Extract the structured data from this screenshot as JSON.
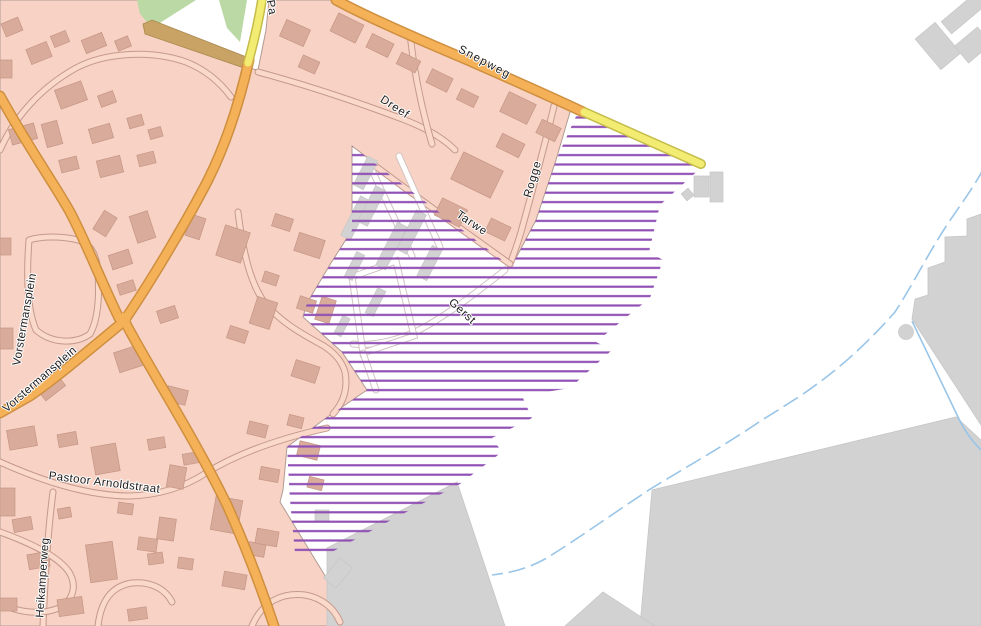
{
  "map": {
    "width": 981,
    "height": 626,
    "colors": {
      "background": "#ffffff",
      "residential": "#F8D3C5",
      "residential_boundary": "#B19B93",
      "building_fill": "#D8AB9B",
      "building_stroke": "#C69685",
      "gray_fill": "#D2D2D2",
      "gray_stroke": "#C6C6C6",
      "road_orange": "#F4B158",
      "road_orange_casing": "#CE8F3F",
      "road_yellow": "#F2EC72",
      "road_yellow_casing": "#C5BC4A",
      "path_tan": "#C9A366",
      "path_tan_stroke": "#A8874E",
      "green": "#BBD9A4",
      "hatch_purple": "#9050B4",
      "water_blue": "#99C5E8",
      "minor_road_fill": "#FAD8CA",
      "minor_road_casing": "#C49A8C",
      "hatch_road_fill": "#FFFFFF",
      "hatch_road_casing": "#D2C4C0"
    },
    "hatch_spacing": 9.4,
    "hatch_line_width": 2.2,
    "residential_area": "0,0 139,0 150,26 148,33 243,67 258,70 266,30 269,0 332,0 380,20 445,48 505,76 560,100 578,110 570,112 556,160 536,220 516,258 510,266 352,146 352,230 331,263 307,303 303,317 342,352 367,390 326,418 287,447 283,490 280,502 338,597 352,626 0,626",
    "green_areas": [
      "137,0 196,0 152,28 140,14",
      "219,0 247,0 240,42 227,28"
    ],
    "tan_path": "143,24 152,20 249,58 244,68 145,34",
    "gray_areas": [
      "967,219 981,214 981,425 912,319 915,299 928,295 928,268 945,262 945,237 967,236",
      "640,626 652,490 956,417 981,440 981,626",
      "457,482 505,626 327,626 327,548",
      "565,626 603,592 655,626"
    ],
    "gray_circle": {
      "cx": 906,
      "cy": 332,
      "r": 8
    },
    "hatch_zone": "352,146 510,266 516,258 536,220 556,160 578,112 585,115 703,166 660,205 649,252 663,260 650,298 596,342 612,350 570,388 522,396 532,418 492,438 502,452 460,484 395,518 330,553 295,553 290,500 287,447 326,418 367,390 342,352 303,317 307,303 331,263 352,230",
    "major_roads": [
      {
        "name": "road-vorstermansplein-north",
        "type": "orange",
        "d": "M 0,96 C 30,150 55,185 70,212 C 85,240 105,290 119,318"
      },
      {
        "name": "road-main-north",
        "type": "orange",
        "d": "M 249,60 C 240,100 228,140 208,180 C 190,215 155,275 126,318"
      },
      {
        "name": "road-main-south",
        "type": "orange",
        "d": "M 124,320 C 150,370 190,430 227,505 C 245,545 262,590 274,626"
      },
      {
        "name": "road-vorstermansplein-southwest",
        "type": "orange",
        "d": "M 123,322 C 95,345 60,375 30,396 L 0,413"
      },
      {
        "name": "road-snepweg",
        "type": "orange",
        "d": "M 336,0 C 365,16 420,40 470,61 C 515,81 556,99 583,112"
      },
      {
        "name": "road-yellow-north",
        "type": "yellow",
        "d": "M 262,0 C 258,25 253,45 248,63"
      },
      {
        "name": "road-yellow-east",
        "type": "yellow",
        "d": "M 584,112 Q 645,139 701,164"
      }
    ],
    "junction": {
      "cx": 124,
      "cy": 319,
      "r": 6
    },
    "minor_roads": [
      {
        "name": "road-dreef",
        "d": "M 258,72 C 310,86 360,103 405,120 C 428,129 444,139 455,150"
      },
      {
        "name": "road-dreef-connector",
        "d": "M 432,144 C 422,110 414,72 410,34"
      },
      {
        "name": "road-rogge",
        "d": "M 554,106 C 546,140 534,185 521,232 C 517,246 513,256 510,264"
      },
      {
        "name": "road-tarwe",
        "d": "M 510,264 C 468,234 418,198 370,162"
      },
      {
        "name": "road-northwest-block",
        "d": "M 0,150 C 14,118 40,88 76,68 C 106,52 152,50 186,62 C 206,70 220,82 231,97"
      },
      {
        "name": "road-plein-ring",
        "d": "M 29,240 C 26,280 28,312 36,330 C 52,344 76,344 90,334 C 99,318 100,290 97,264 C 94,250 88,243 78,240 C 62,236 42,236 29,240"
      },
      {
        "name": "road-east-loop",
        "d": "M 238,212 C 243,252 250,282 264,302 C 282,324 306,336 324,346 C 336,354 342,362 345,372 C 348,388 344,402 333,414"
      },
      {
        "name": "road-pastoor-arnoldstraat",
        "d": "M 0,462 C 40,480 86,496 130,496 C 162,495 186,486 206,473 C 240,452 282,438 327,428"
      },
      {
        "name": "road-heikamperweg",
        "d": "M 53,492 C 48,530 45,575 43,626"
      },
      {
        "name": "road-southwest-loop",
        "d": "M 0,532 C 28,542 58,556 69,572 C 77,585 74,600 59,608 C 40,616 14,612 0,602"
      },
      {
        "name": "road-south-curl",
        "d": "M 98,626 C 101,600 112,586 132,583 C 152,581 166,590 172,602"
      },
      {
        "name": "road-south-curl-2",
        "d": "M 252,626 C 262,602 282,592 305,595 C 322,598 334,608 340,622"
      }
    ],
    "hatch_roads": [
      {
        "name": "road-gerst",
        "d": "M 505,270 C 472,296 443,318 417,331 C 396,341 372,346 353,344"
      },
      {
        "name": "road-gerst-loop",
        "d": "M 352,277 L 396,261 L 414,336 L 363,353 Z"
      },
      {
        "name": "road-gerst-spur",
        "d": "M 363,353 L 376,390"
      },
      {
        "name": "road-hatch-lane-1",
        "d": "M 371,168 C 385,198 399,228 412,256"
      },
      {
        "name": "road-hatch-lane-2",
        "d": "M 399,156 C 412,186 427,218 440,247"
      }
    ],
    "buildings_residential": [
      [
        3,
        20,
        18,
        14,
        -22
      ],
      [
        28,
        45,
        22,
        16,
        -22
      ],
      [
        52,
        33,
        16,
        12,
        -22
      ],
      [
        0,
        60,
        12,
        18,
        0
      ],
      [
        83,
        36,
        22,
        14,
        -22
      ],
      [
        116,
        38,
        14,
        11,
        -22
      ],
      [
        57,
        85,
        28,
        20,
        -20
      ],
      [
        99,
        93,
        16,
        12,
        -20
      ],
      [
        10,
        126,
        26,
        16,
        -15
      ],
      [
        44,
        122,
        16,
        24,
        -15
      ],
      [
        90,
        126,
        22,
        15,
        -16
      ],
      [
        128,
        116,
        15,
        11,
        -16
      ],
      [
        149,
        128,
        13,
        10,
        -16
      ],
      [
        60,
        158,
        18,
        13,
        -14
      ],
      [
        98,
        158,
        24,
        17,
        -14
      ],
      [
        138,
        153,
        17,
        12,
        -14
      ],
      [
        282,
        24,
        26,
        18,
        24
      ],
      [
        300,
        58,
        18,
        13,
        24
      ],
      [
        333,
        18,
        28,
        20,
        26
      ],
      [
        368,
        38,
        24,
        15,
        26
      ],
      [
        398,
        56,
        21,
        13,
        26
      ],
      [
        428,
        73,
        23,
        15,
        26
      ],
      [
        458,
        92,
        19,
        12,
        26
      ],
      [
        503,
        97,
        30,
        22,
        26
      ],
      [
        538,
        123,
        21,
        15,
        26
      ],
      [
        498,
        138,
        25,
        15,
        26
      ],
      [
        455,
        160,
        44,
        30,
        26
      ],
      [
        437,
        203,
        28,
        19,
        26
      ],
      [
        487,
        222,
        22,
        15,
        26
      ],
      [
        94,
        216,
        22,
        15,
        -58
      ],
      [
        133,
        213,
        19,
        28,
        -18
      ],
      [
        110,
        252,
        21,
        15,
        -18
      ],
      [
        118,
        282,
        17,
        11,
        -18
      ],
      [
        188,
        216,
        15,
        22,
        18
      ],
      [
        220,
        228,
        26,
        32,
        18
      ],
      [
        273,
        216,
        19,
        13,
        18
      ],
      [
        296,
        236,
        27,
        19,
        18
      ],
      [
        263,
        273,
        15,
        11,
        18
      ],
      [
        253,
        299,
        21,
        28,
        18
      ],
      [
        298,
        298,
        17,
        13,
        18
      ],
      [
        158,
        308,
        19,
        13,
        -18
      ],
      [
        116,
        348,
        28,
        21,
        -18
      ],
      [
        38,
        378,
        25,
        17,
        -38
      ],
      [
        0,
        328,
        13,
        21,
        0
      ],
      [
        0,
        238,
        11,
        17,
        0
      ],
      [
        166,
        388,
        21,
        15,
        14
      ],
      [
        228,
        328,
        19,
        13,
        18
      ],
      [
        293,
        363,
        25,
        17,
        18
      ],
      [
        318,
        298,
        15,
        24,
        18
      ],
      [
        8,
        428,
        28,
        20,
        -10
      ],
      [
        58,
        433,
        19,
        13,
        -10
      ],
      [
        93,
        445,
        25,
        28,
        -10
      ],
      [
        148,
        438,
        17,
        11,
        -10
      ],
      [
        183,
        453,
        15,
        11,
        -10
      ],
      [
        0,
        488,
        15,
        28,
        0
      ],
      [
        13,
        518,
        19,
        13,
        -10
      ],
      [
        58,
        508,
        13,
        10,
        -10
      ],
      [
        28,
        553,
        21,
        15,
        -10
      ],
      [
        88,
        543,
        27,
        38,
        -8
      ],
      [
        148,
        553,
        15,
        11,
        -8
      ],
      [
        0,
        598,
        17,
        13,
        0
      ],
      [
        58,
        598,
        25,
        17,
        -8
      ],
      [
        128,
        608,
        19,
        12,
        -8
      ],
      [
        213,
        498,
        27,
        34,
        10
      ],
      [
        248,
        543,
        17,
        13,
        10
      ],
      [
        223,
        573,
        23,
        15,
        10
      ],
      [
        168,
        466,
        17,
        22,
        10
      ],
      [
        260,
        468,
        19,
        13,
        10
      ],
      [
        298,
        443,
        21,
        15,
        14
      ],
      [
        308,
        478,
        15,
        11,
        14
      ],
      [
        248,
        423,
        19,
        13,
        14
      ],
      [
        288,
        416,
        15,
        11,
        14
      ],
      [
        256,
        530,
        22,
        15,
        10
      ],
      [
        158,
        518,
        17,
        22,
        8
      ],
      [
        118,
        503,
        15,
        11,
        8
      ],
      [
        138,
        538,
        19,
        13,
        8
      ],
      [
        178,
        558,
        15,
        11,
        8
      ]
    ],
    "buildings_gray": [
      [
        941,
        5,
        46,
        16,
        -40
      ],
      [
        925,
        26,
        26,
        40,
        -40
      ],
      [
        958,
        34,
        30,
        22,
        -40
      ],
      [
        694,
        176,
        15,
        21,
        0
      ],
      [
        710,
        172,
        13,
        30,
        0
      ],
      [
        683,
        190,
        9,
        9,
        -40
      ],
      [
        350,
        196,
        11,
        44,
        27
      ],
      [
        366,
        186,
        11,
        40,
        27
      ],
      [
        386,
        222,
        11,
        48,
        27
      ],
      [
        406,
        210,
        11,
        44,
        27
      ],
      [
        350,
        252,
        9,
        28,
        27
      ],
      [
        424,
        246,
        11,
        34,
        27
      ],
      [
        371,
        288,
        9,
        28,
        27
      ],
      [
        338,
        316,
        8,
        20,
        27
      ],
      [
        360,
        157,
        11,
        32,
        27
      ],
      [
        315,
        510,
        14,
        12,
        0
      ],
      [
        330,
        560,
        16,
        26,
        40
      ]
    ],
    "streams": [
      {
        "name": "stream-main",
        "d": "M 984,168 C 972,190 960,205 945,228 C 928,254 912,286 895,312 C 872,338 842,368 800,396 C 780,409 770,415 762,420 C 730,442 695,462 652,488 C 615,512 575,541 545,559 C 525,570 508,573 492,575",
        "dash": "17 6"
      },
      {
        "name": "stream-branch",
        "d": "M 912,321 C 927,352 944,388 958,417 C 964,430 972,441 981,450",
        "dash": ""
      }
    ],
    "labels": [
      {
        "text": "Snepweg",
        "x": 483,
        "y": 65,
        "rot": 28,
        "ls": 1.4
      },
      {
        "text": "Pa",
        "x": 268,
        "y": 8,
        "rot": 80,
        "ls": 0.5
      },
      {
        "text": "Dreef",
        "x": 393,
        "y": 110,
        "rot": 33,
        "ls": 0.8
      },
      {
        "text": "Rogge",
        "x": 536,
        "y": 180,
        "rot": -74,
        "ls": 0.8
      },
      {
        "text": "Tarwe",
        "x": 470,
        "y": 226,
        "rot": 34,
        "ls": 0.8
      },
      {
        "text": "Gerst",
        "x": 460,
        "y": 314,
        "rot": 42,
        "ls": 0.8
      },
      {
        "text": "Vorstermansplein",
        "x": 28,
        "y": 320,
        "rot": -80,
        "ls": 0.3
      },
      {
        "text": "Vorstermansplein",
        "x": 42,
        "y": 382,
        "rot": -41,
        "ls": 0.3
      },
      {
        "text": "Pastoor Arnoldstraat",
        "x": 104,
        "y": 486,
        "rot": 7,
        "ls": 0.4
      },
      {
        "text": "Heikamperweg",
        "x": 46,
        "y": 578,
        "rot": -86,
        "ls": 0.3
      }
    ]
  }
}
